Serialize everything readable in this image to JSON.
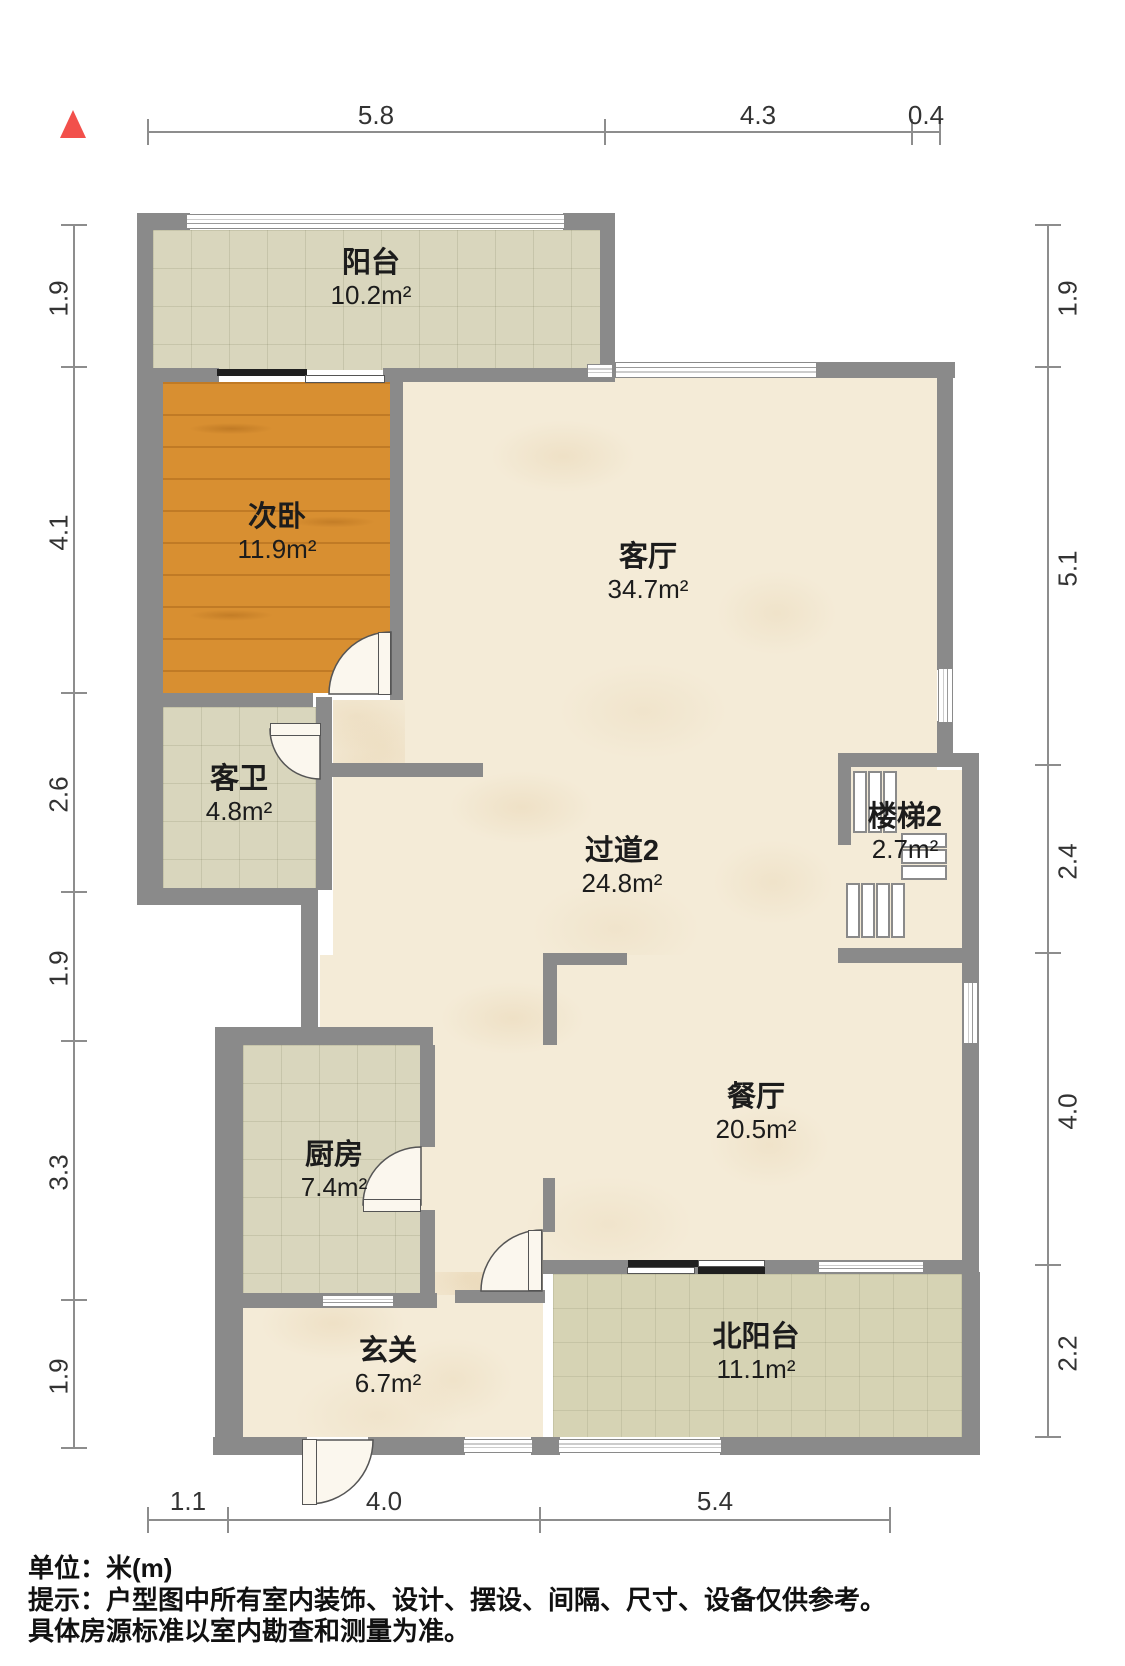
{
  "north_indicator": {
    "icon": "north-arrow",
    "color": "#f2504b"
  },
  "rooms": [
    {
      "id": "balcony",
      "name": "阳台",
      "area": "10.2m²"
    },
    {
      "id": "second-bedroom",
      "name": "次卧",
      "area": "11.9m²"
    },
    {
      "id": "living-room",
      "name": "客厅",
      "area": "34.7m²"
    },
    {
      "id": "guest-bathroom",
      "name": "客卫",
      "area": "4.8m²"
    },
    {
      "id": "hallway-2",
      "name": "过道2",
      "area": "24.8m²"
    },
    {
      "id": "stairs-2",
      "name": "楼梯2",
      "area": "2.7m²"
    },
    {
      "id": "kitchen",
      "name": "厨房",
      "area": "7.4m²"
    },
    {
      "id": "dining-room",
      "name": "餐厅",
      "area": "20.5m²"
    },
    {
      "id": "entry-hall",
      "name": "玄关",
      "area": "6.7m²"
    },
    {
      "id": "north-balcony",
      "name": "北阳台",
      "area": "11.1m²"
    }
  ],
  "dimensions": {
    "top": [
      "5.8",
      "4.3",
      "0.4"
    ],
    "left": [
      "1.9",
      "4.1",
      "2.6",
      "1.9",
      "3.3",
      "1.9"
    ],
    "right": [
      "1.9",
      "5.1",
      "2.4",
      "4.0",
      "2.2"
    ],
    "bottom": [
      "1.1",
      "4.0",
      "5.4"
    ]
  },
  "footer": {
    "unit": "单位：米(m)",
    "tip_line1": "提示：户型图中所有室内装饰、设计、摆设、间隔、尺寸、设备仅供参考。",
    "tip_line2": "具体房源标准以室内勘查和测量为准。"
  },
  "colors": {
    "wall": "#8a8a8a",
    "wood_floor": "#d88f31",
    "tile_floor": "#d9d6bd",
    "north_balcony_tile": "#d6d3b4",
    "marble_floor": "#f4ebd7",
    "north_arrow": "#f2504b",
    "dimension_line": "#8d8d8d",
    "label_text": "#1c1c1c"
  }
}
